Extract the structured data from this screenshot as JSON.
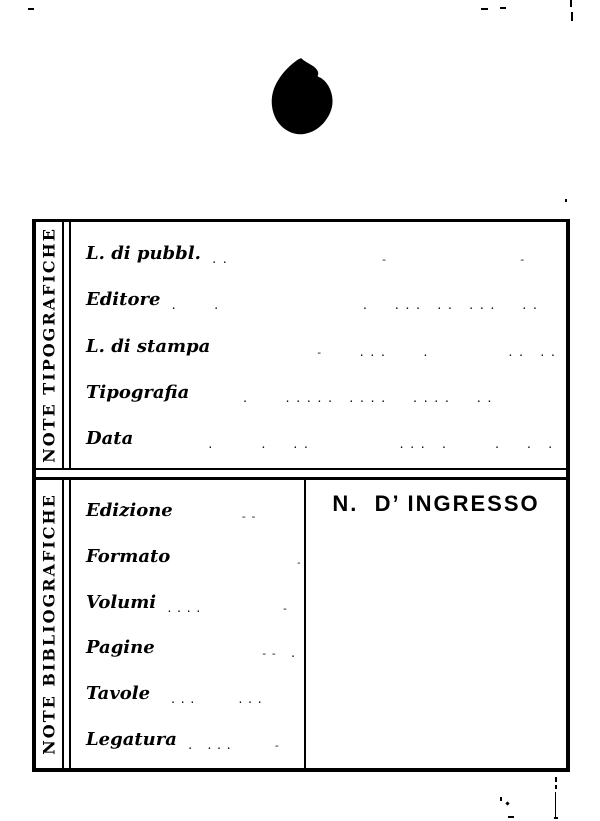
{
  "sections": [
    {
      "side_label": "NOTE TIPOGRAFICHE",
      "fields": [
        {
          "label": "L. di pubbl.",
          "leader": "..              -            -"
        },
        {
          "label": "Editore",
          "leader": ".   .             .  ... .. ...  ..  .."
        },
        {
          "label": "L. di stampa",
          "leader": "         -   ...   .       .. .."
        },
        {
          "label": "Tipografia",
          "leader": "    .   ..... ....  ....  ..      .  .."
        },
        {
          "label": "Data",
          "leader": "      .    .  ..        ... .    .  . ...... . ."
        }
      ]
    },
    {
      "side_label": "NOTE BIBLIOGRAFICHE",
      "fields": [
        {
          "label": "Edizione",
          "leader": "      --"
        },
        {
          "label": "Formato",
          "leader": "            --"
        },
        {
          "label": "Volumi",
          "leader": "....        -"
        },
        {
          "label": "Pagine",
          "leader": "          -- ."
        },
        {
          "label": "Tavole",
          "leader": " ...    ..."
        },
        {
          "label": "Legatura",
          "leader": ". ...    -"
        }
      ],
      "ingresso_label": "N.  D’ INGRESSO"
    }
  ]
}
